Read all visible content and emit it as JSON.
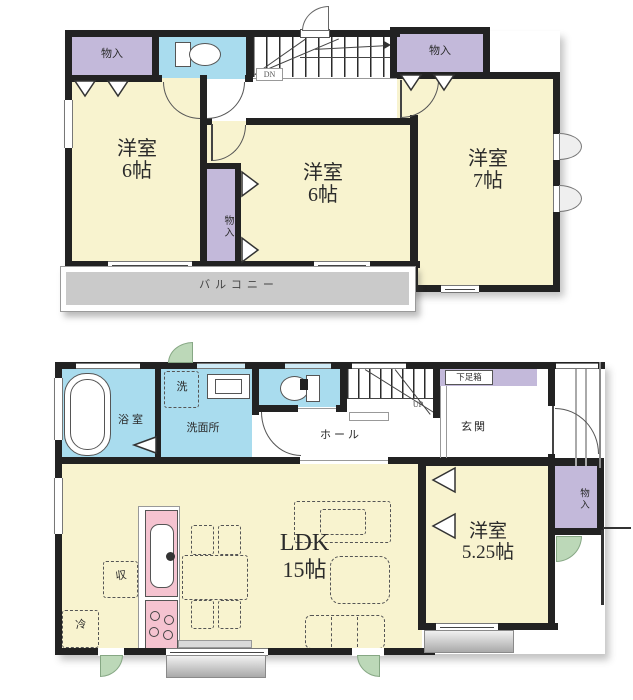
{
  "floor2": {
    "closet_a": "物入",
    "closet_b": "物入",
    "closet_c": "物入",
    "room_left_name": "洋室",
    "room_left_size": "6帖",
    "room_mid_name": "洋室",
    "room_mid_size": "6帖",
    "room_right_name": "洋室",
    "room_right_size": "7帖",
    "balcony": "バルコニー",
    "stairs_label": "DN"
  },
  "floor1": {
    "bath": "浴室",
    "laundry": "洗",
    "washroom": "洗面所",
    "hall": "ホール",
    "shoe_cabinet": "下足箱",
    "entrance": "玄関",
    "stairs_label": "UP",
    "ldk_name": "LDK",
    "ldk_size": "15帖",
    "room_name": "洋室",
    "room_size": "5.25帖",
    "closet": "物入",
    "storage": "収",
    "refrigerator": "冷"
  },
  "colors": {
    "room_fill": "#f8f3cf",
    "closet_fill": "#c3b9da",
    "wet_area_fill": "#a9dcee",
    "kitchen_fill": "#f5c3d0",
    "balcony_fill": "#cacaca",
    "exterior_door_green": "#bcd8b8",
    "wall": "#222222"
  }
}
